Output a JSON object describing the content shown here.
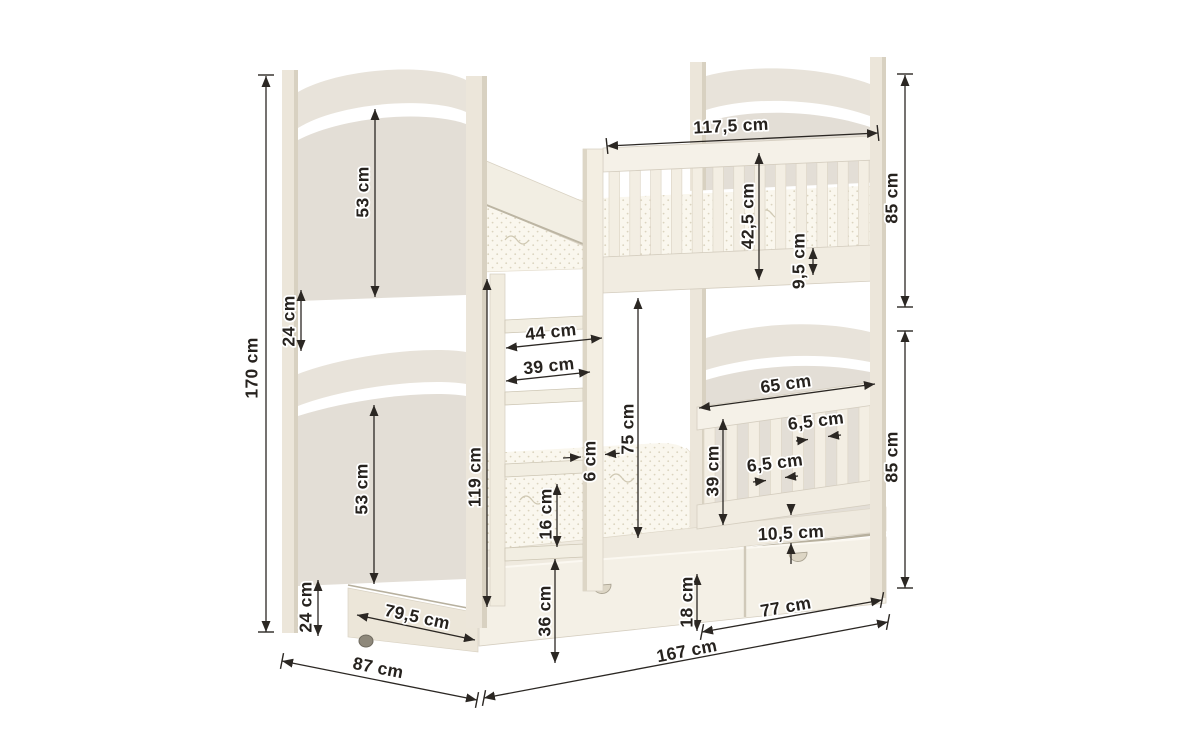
{
  "meta": {
    "type": "furniture-dimension-diagram",
    "subject": "wooden bunk bed with ladder, guard rails and under-bed drawers",
    "unit": "cm",
    "background": "#ffffff"
  },
  "palette": {
    "dim_line": "#2b2723",
    "dim_text": "#26221e",
    "post": "#ece6da",
    "post_shade": "#d8d1c1",
    "panel": "#e3ded6",
    "arc_band": "#e8e3da",
    "rail": "#f5f1e8",
    "slat": "#f3eee3",
    "bottom_rail": "#f1ece1",
    "band": "#efeadf",
    "drawer": "#f4f0e6",
    "drawer_side": "#ece6d9",
    "mattress": "#faf7ee",
    "mattress_dot": "#dbd4bf",
    "crevice": "#b7b09e",
    "caster": "#8e887b",
    "edge": "#d5cec0"
  },
  "bed": {
    "upper_railing": {
      "slat_count": 13
    },
    "lower_railing": {
      "slat_count": 8
    },
    "ladder": {
      "rung_count": 4
    }
  },
  "dimensions": [
    {
      "id": "total-height",
      "label": "170 cm",
      "tx": 253,
      "ty": 368,
      "rot": -90,
      "lines": [
        [
          266,
          76,
          266,
          632,
          "both"
        ]
      ],
      "ticks": [
        [
          266,
          75,
          0
        ],
        [
          266,
          632,
          0
        ]
      ]
    },
    {
      "id": "upper-headboard-panel-height",
      "label": "53 cm",
      "tx": 364,
      "ty": 192,
      "rot": -90,
      "lines": [
        [
          375,
          109,
          375,
          297,
          "both"
        ]
      ],
      "ticks": []
    },
    {
      "id": "upper-gap-height",
      "label": "24 cm",
      "tx": 290,
      "ty": 321,
      "rot": -90,
      "lines": [
        [
          301,
          290,
          301,
          351,
          "both"
        ]
      ],
      "ticks": []
    },
    {
      "id": "lower-headboard-panel-height",
      "label": "53 cm",
      "tx": 363,
      "ty": 489,
      "rot": -90,
      "lines": [
        [
          374,
          405,
          374,
          584,
          "both"
        ]
      ],
      "ticks": []
    },
    {
      "id": "bottom-gap-height",
      "label": "24 cm",
      "tx": 307,
      "ty": 607,
      "rot": -90,
      "lines": [
        [
          318,
          580,
          318,
          636,
          "both"
        ]
      ],
      "ticks": []
    },
    {
      "id": "drawer-depth",
      "label": "79,5 cm",
      "tx": 417,
      "ty": 618,
      "rot": 12,
      "lines": [
        [
          357,
          615,
          475,
          640,
          "both"
        ]
      ],
      "ticks": []
    },
    {
      "id": "bed-width",
      "label": "87 cm",
      "tx": 378,
      "ty": 669,
      "rot": 11,
      "lines": [
        [
          282,
          661,
          477,
          700,
          "both"
        ]
      ],
      "ticks": [
        [
          282,
          661,
          101
        ],
        [
          477,
          700,
          101
        ]
      ]
    },
    {
      "id": "under-upper-bunk-height",
      "label": "119 cm",
      "tx": 476,
      "ty": 477,
      "rot": -90,
      "lines": [
        [
          487,
          279,
          487,
          607,
          "both"
        ]
      ],
      "ticks": []
    },
    {
      "id": "ladder-outer-width",
      "label": "44 cm",
      "tx": 551,
      "ty": 333,
      "rot": -6,
      "lines": [
        [
          506,
          348,
          602,
          338,
          "both"
        ]
      ],
      "ticks": []
    },
    {
      "id": "ladder-inner-width",
      "label": "39 cm",
      "tx": 549,
      "ty": 367,
      "rot": -6,
      "lines": [
        [
          506,
          381,
          590,
          372,
          "both"
        ]
      ],
      "ticks": []
    },
    {
      "id": "ladder-stile-width",
      "label": "6 cm",
      "tx": 591,
      "ty": 461,
      "rot": -90,
      "lines": [
        [
          563,
          458,
          581,
          457,
          "end"
        ],
        [
          623,
          453,
          605,
          454.5,
          "end"
        ]
      ],
      "ticks": []
    },
    {
      "id": "mattress-height",
      "label": "16 cm",
      "tx": 547,
      "ty": 514,
      "rot": -90,
      "lines": [
        [
          557,
          484,
          557,
          547,
          "both"
        ]
      ],
      "ticks": []
    },
    {
      "id": "bunk-clearance",
      "label": "75 cm",
      "tx": 629,
      "ty": 429,
      "rot": -90,
      "lines": [
        [
          638,
          298,
          638,
          538,
          "both"
        ]
      ],
      "ticks": []
    },
    {
      "id": "underbed-height",
      "label": "36 cm",
      "tx": 546,
      "ty": 611,
      "rot": -90,
      "lines": [
        [
          555,
          559,
          555,
          663,
          "both"
        ]
      ],
      "ticks": []
    },
    {
      "id": "upper-rail-length",
      "label": "117,5 cm",
      "tx": 731,
      "ty": 127,
      "rot": -3,
      "lines": [
        [
          607,
          146,
          878,
          133,
          "both"
        ]
      ],
      "ticks": [
        [
          607,
          146,
          84
        ],
        [
          878,
          133,
          84
        ]
      ]
    },
    {
      "id": "upper-guardrail-height",
      "label": "42,5 cm",
      "tx": 749,
      "ty": 216,
      "rot": -90,
      "lines": [
        [
          759,
          153,
          759,
          280,
          "both"
        ]
      ],
      "ticks": []
    },
    {
      "id": "guardrail-above-mattress",
      "label": "9,5 cm",
      "tx": 800,
      "ty": 261,
      "rot": -90,
      "lines": [
        [
          813,
          248,
          813,
          275,
          "both"
        ]
      ],
      "ticks": []
    },
    {
      "id": "upper-section-height",
      "label": "85 cm",
      "tx": 893,
      "ty": 198,
      "rot": -90,
      "lines": [
        [
          905,
          75,
          905,
          307,
          "both"
        ]
      ],
      "ticks": [
        [
          905,
          74,
          0
        ],
        [
          905,
          307,
          0
        ]
      ]
    },
    {
      "id": "lower-guardrail-length",
      "label": "65 cm",
      "tx": 786,
      "ty": 385,
      "rot": -8,
      "lines": [
        [
          699,
          408,
          875,
          384,
          "both"
        ]
      ],
      "ticks": []
    },
    {
      "id": "slat-width-upper",
      "label": "6,5 cm",
      "tx": 816,
      "ty": 422,
      "rot": -7,
      "lines": [
        [
          796,
          441,
          808,
          439.5,
          "end"
        ],
        [
          841,
          435,
          828,
          436.5,
          "end"
        ]
      ],
      "ticks": []
    },
    {
      "id": "slat-width-lower",
      "label": "6,5 cm",
      "tx": 775,
      "ty": 464,
      "rot": -7,
      "lines": [
        [
          753,
          482,
          766,
          480.5,
          "end"
        ],
        [
          798,
          476,
          785,
          477.5,
          "end"
        ]
      ],
      "ticks": []
    },
    {
      "id": "lower-guardrail-height",
      "label": "39 cm",
      "tx": 714,
      "ty": 471,
      "rot": -90,
      "lines": [
        [
          723,
          419,
          723,
          525,
          "both"
        ]
      ],
      "ticks": []
    },
    {
      "id": "side-rail-board-height",
      "label": "10,5 cm",
      "tx": 791,
      "ty": 534,
      "rot": -3,
      "lines": [
        [
          791,
          504,
          791,
          515,
          "end"
        ],
        [
          791,
          564,
          791,
          543,
          "end"
        ]
      ],
      "ticks": []
    },
    {
      "id": "drawer-front-height",
      "label": "18 cm",
      "tx": 688,
      "ty": 602,
      "rot": -90,
      "lines": [
        [
          697,
          574,
          697,
          631,
          "both"
        ]
      ],
      "ticks": []
    },
    {
      "id": "drawer-front-width",
      "label": "77 cm",
      "tx": 786,
      "ty": 608,
      "rot": -10,
      "lines": [
        [
          702,
          632,
          882,
          600,
          "both"
        ]
      ],
      "ticks": [
        [
          702,
          632,
          101
        ],
        [
          882,
          600,
          101
        ]
      ]
    },
    {
      "id": "bed-length",
      "label": "167 cm",
      "tx": 687,
      "ty": 652,
      "rot": -11,
      "lines": [
        [
          484,
          698,
          888,
          622,
          "both"
        ]
      ],
      "ticks": [
        [
          484,
          698,
          101
        ],
        [
          888,
          622,
          101
        ]
      ]
    },
    {
      "id": "lower-section-height",
      "label": "85 cm",
      "tx": 893,
      "ty": 457,
      "rot": -90,
      "lines": [
        [
          905,
          331,
          905,
          588,
          "both"
        ]
      ],
      "ticks": [
        [
          905,
          331,
          0
        ],
        [
          905,
          588,
          0
        ]
      ]
    }
  ]
}
